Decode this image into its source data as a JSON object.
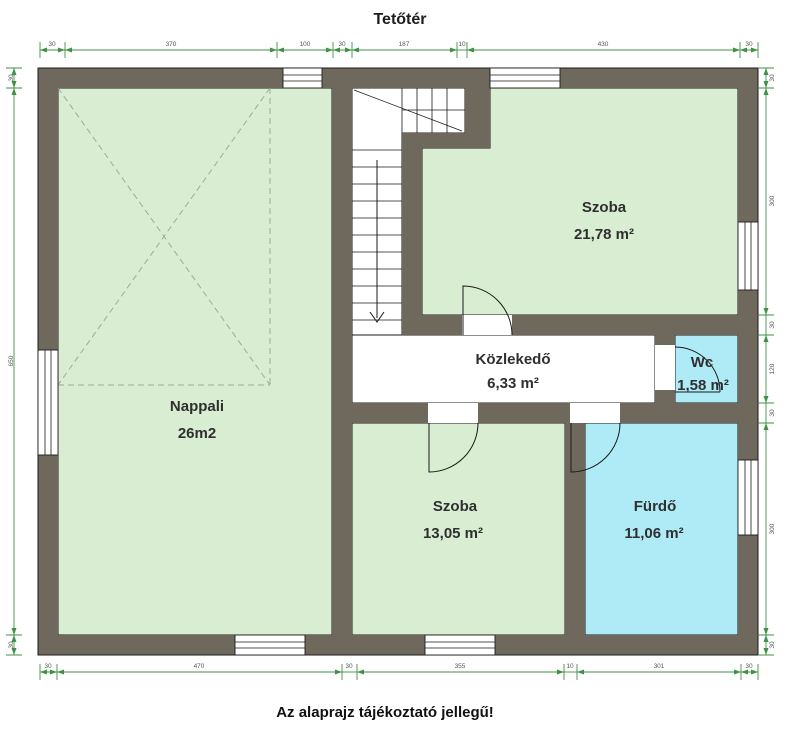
{
  "title": "Tetőtér",
  "footer_note": "Az alaprajz tájékoztató jellegű!",
  "rooms": [
    {
      "id": "nappali",
      "name": "Nappali",
      "area": "26m2",
      "fill": "#d8edd2"
    },
    {
      "id": "szoba-felso",
      "name": "Szoba",
      "area": "21,78 m²",
      "fill": "#d8edd2"
    },
    {
      "id": "kozlekedo",
      "name": "Közlekedő",
      "area": "6,33 m²",
      "fill": "#ffffff"
    },
    {
      "id": "wc",
      "name": "Wc",
      "area": "1,58 m²",
      "fill": "#aeebf6"
    },
    {
      "id": "szoba-also",
      "name": "Szoba",
      "area": "13,05 m²",
      "fill": "#d8edd2"
    },
    {
      "id": "furdo",
      "name": "Fürdő",
      "area": "11,06 m²",
      "fill": "#aeebf6"
    }
  ],
  "colors": {
    "wall": "#6f685d",
    "outline": "#1b1b1b",
    "room_green": "#d8edd2",
    "room_cyan": "#aeebf6",
    "room_white": "#ffffff",
    "dimension": "#3f9145",
    "roof_dash": "#a3a89e",
    "watermark": "#f0efeb"
  },
  "dimensions": {
    "top": [
      "30",
      "370",
      "100",
      "30",
      "187",
      "10",
      "430",
      "30"
    ],
    "bottom": [
      "30",
      "470",
      "30",
      "355",
      "10",
      "301",
      "30"
    ],
    "left": [
      "30",
      "650",
      "30"
    ],
    "right": [
      "30",
      "300",
      "30",
      "120",
      "30",
      "300",
      "30"
    ]
  }
}
